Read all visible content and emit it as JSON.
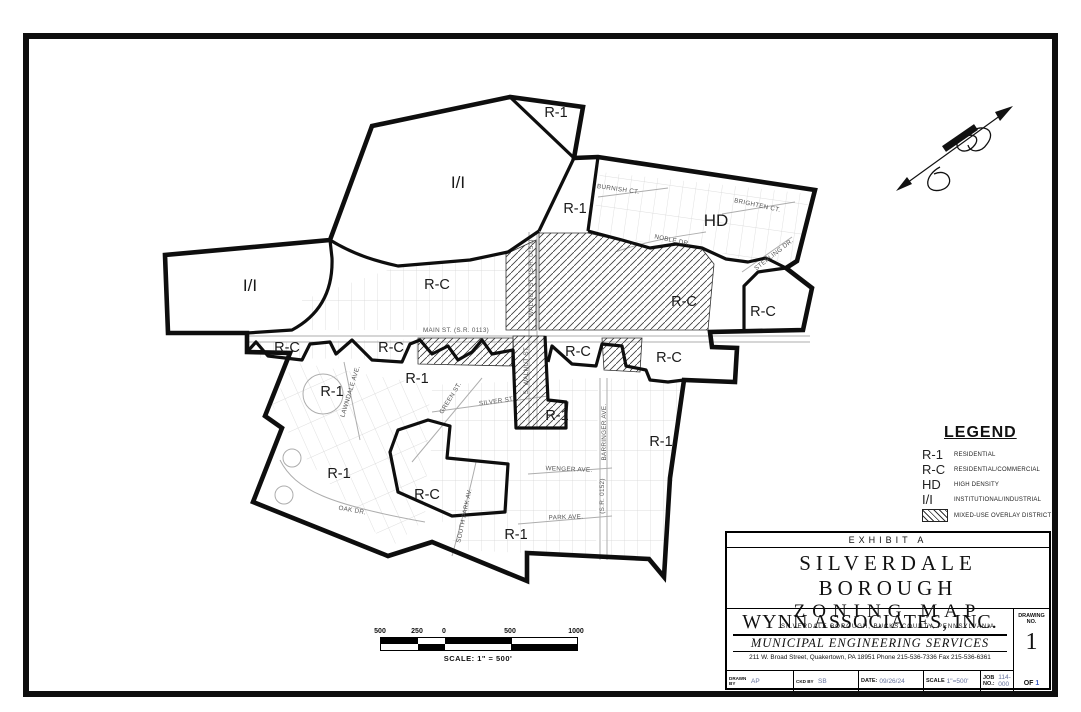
{
  "title_block": {
    "exhibit": "EXHIBIT  A",
    "title_line1": "SILVERDALE  BOROUGH",
    "title_line2": "ZONING  MAP",
    "subtitle": "SILVERDALE BOROUGH, BUCKS COUNTY, PENNSYLVANIA",
    "company": "WYNN ASSOCIATES, INC.",
    "tagline": "MUNICIPAL ENGINEERING SERVICES",
    "address": "211 W. Broad Street, Quakertown, PA 18951   Phone 215-536-7336   Fax 215-536-6361",
    "drawn_by_label": "DRAWN BY",
    "drawn_by": "AP",
    "ckd_by_label": "CKD BY",
    "ckd_by": "SB",
    "date_label": "DATE:",
    "date": "09/26/24",
    "scale_label": "SCALE",
    "scale": "1\"=500'",
    "job_label": "JOB NO.:",
    "job": "114-000",
    "drawing_no_label": "DRAWING",
    "drawing_no_label2": "NO.",
    "drawing_no": "1",
    "of_label": "OF",
    "of_value": "1"
  },
  "legend": {
    "heading": "LEGEND",
    "items": [
      {
        "code": "R-1",
        "desc": "RESIDENTIAL"
      },
      {
        "code": "R-C",
        "desc": "RESIDENTIAL/COMMERCIAL"
      },
      {
        "code": "HD",
        "desc": "HIGH DENSITY"
      },
      {
        "code": "I/I",
        "desc": "INSTITUTIONAL/INDUSTRIAL"
      }
    ],
    "overlay_desc": "MIXED-USE OVERLAY DISTRICT"
  },
  "scale_bar": {
    "ticks": [
      "500",
      "250",
      "0",
      "500",
      "1000"
    ],
    "caption": "SCALE: 1\" = 500'"
  },
  "map": {
    "zones": [
      "R-1",
      "I/I",
      "R-1",
      "HD",
      "I/I",
      "R-C",
      "R-C",
      "R-C",
      "R-C",
      "R-C",
      "R-C",
      "R-C",
      "R-1",
      "R-1",
      "R-1",
      "R-1",
      "R-1",
      "R-C",
      "R-1"
    ],
    "streets": {
      "burnish": "BURNISH CT.",
      "brighten": "BRIGHTEN CT.",
      "noble": "NOBLE DR.",
      "sterling": "STERLING DR.",
      "main": "MAIN ST. (S.R. 0113)",
      "walnut": "WALNUT ST. (S.R. 0152)",
      "s_walnut": "S. WALNUT ST.",
      "lawndale": "LAWNDALE AVE.",
      "green": "GREEN ST.",
      "silver": "SILVER ST.",
      "oak": "OAK DR.",
      "south_park": "SOUTH PARK AV.",
      "wenger": "WENGER AVE.",
      "park": "PARK AVE.",
      "barringer": "BARRINGER AVE.",
      "sr0152": "(S.R. 0152)"
    }
  }
}
